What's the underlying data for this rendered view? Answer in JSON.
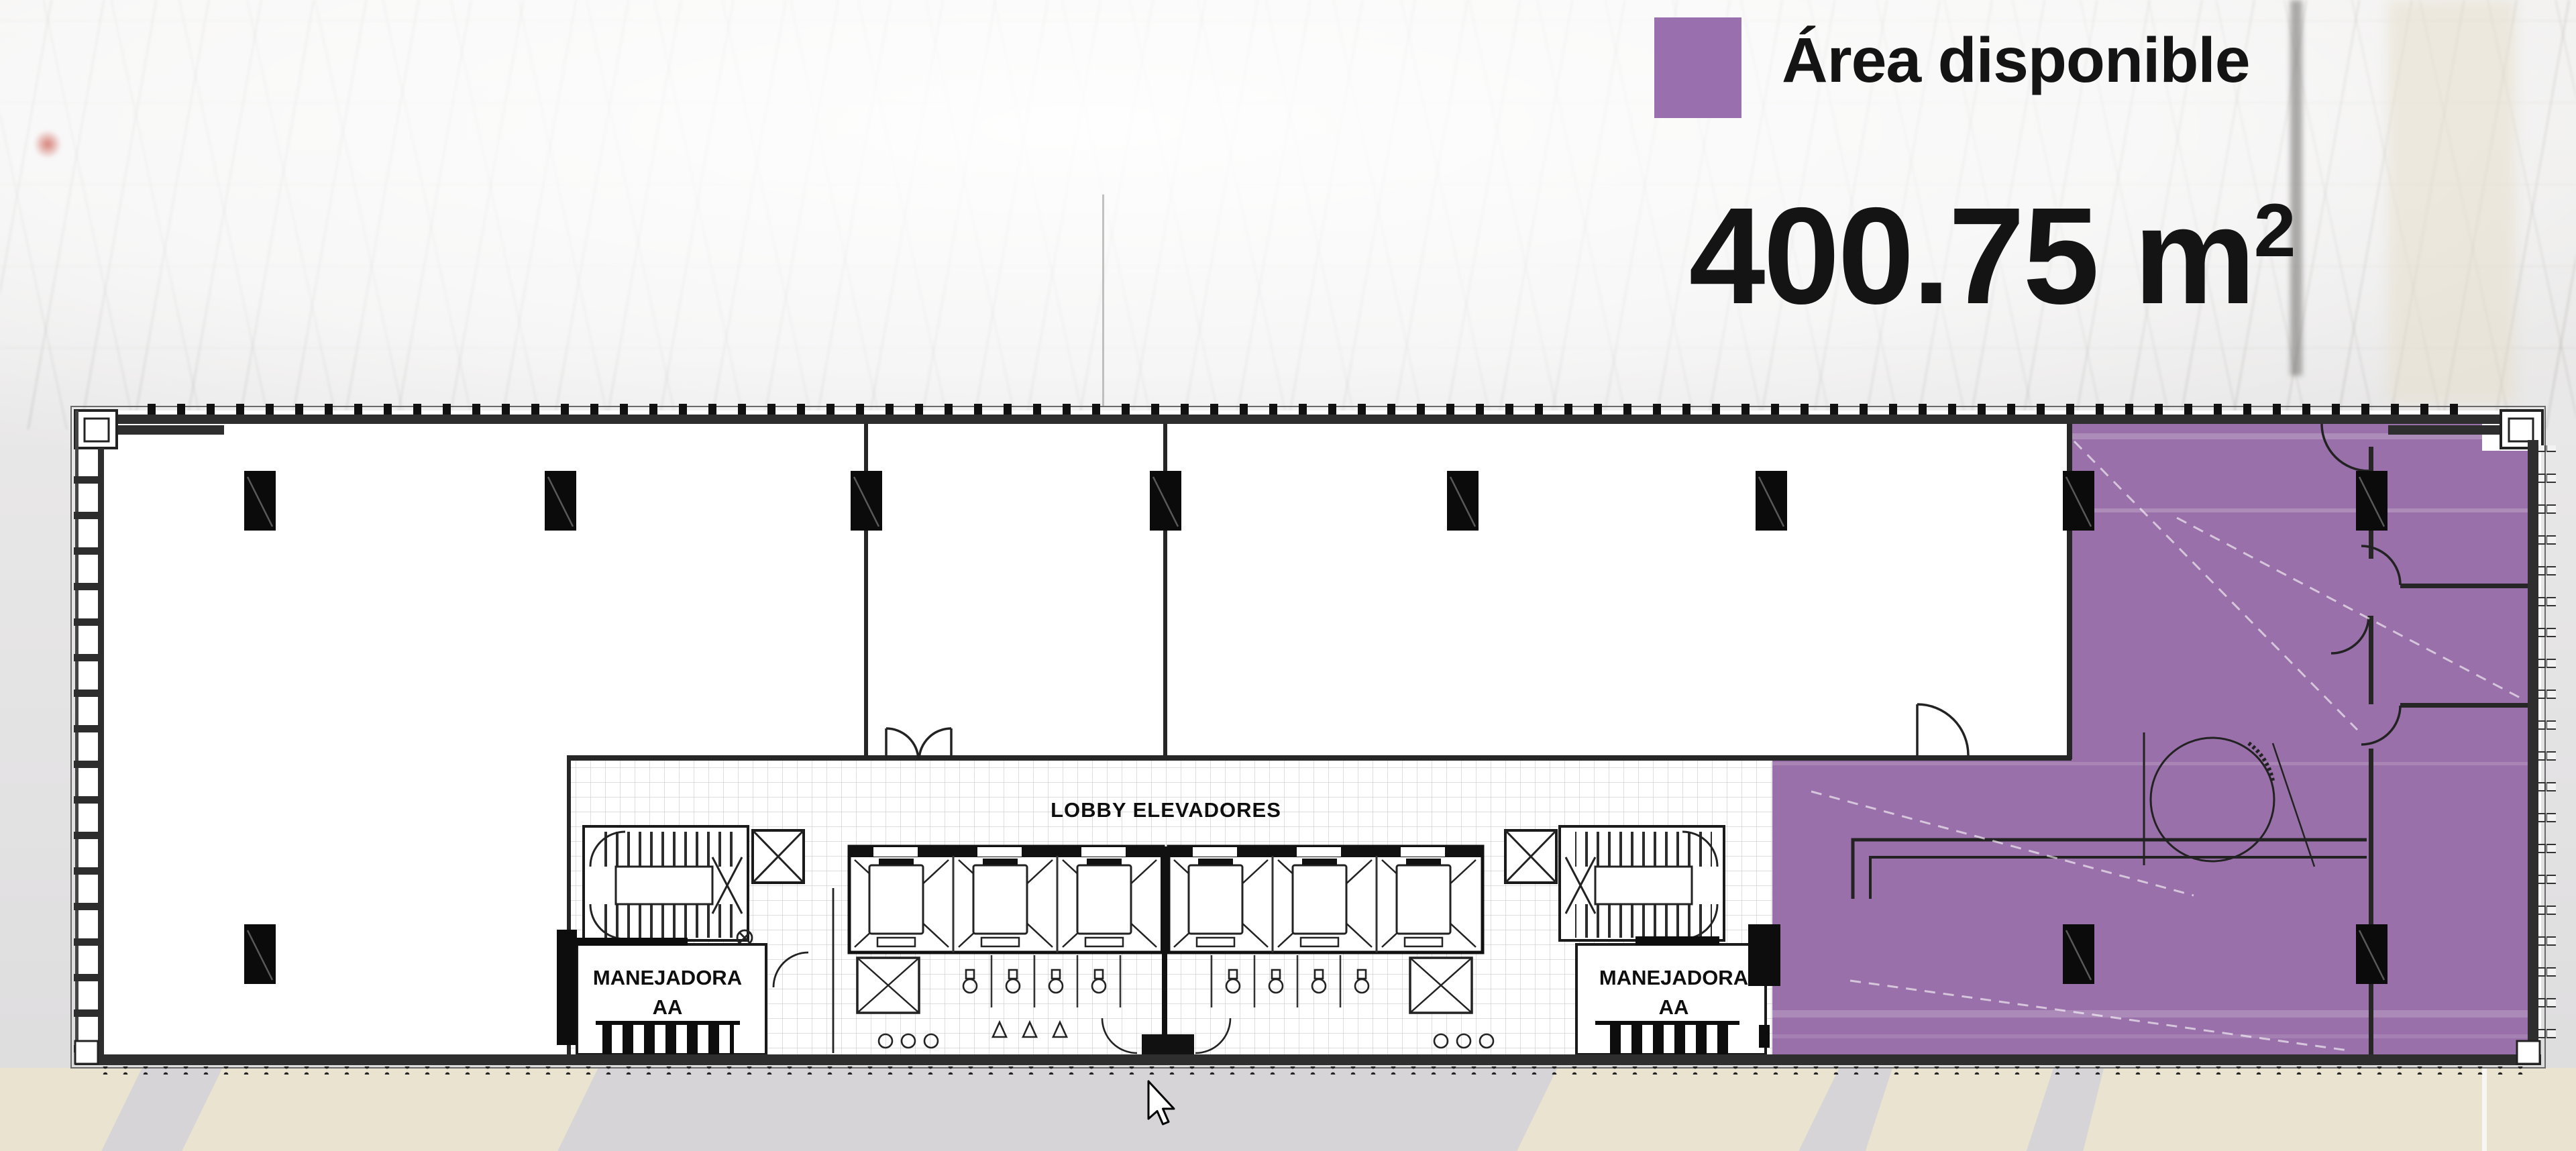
{
  "legend": {
    "swatch_color": "#9a6fae",
    "label": "Área disponible"
  },
  "area_stat": {
    "full_text": "400.75 m²",
    "base": "400.75 m",
    "sup": "2"
  },
  "floor_plan": {
    "highlight_color": "#9970a9",
    "line_color": "#1c1c1c",
    "labels": {
      "lobby": "LOBBY ELEVADORES",
      "manejadora_left_line1": "MANEJADORA",
      "manejadora_left_line2": "AA",
      "manejadora_right_line1": "MANEJADORA",
      "manejadora_right_line2": "AA"
    }
  },
  "cursor": {
    "kind": "arrow-pointer"
  }
}
